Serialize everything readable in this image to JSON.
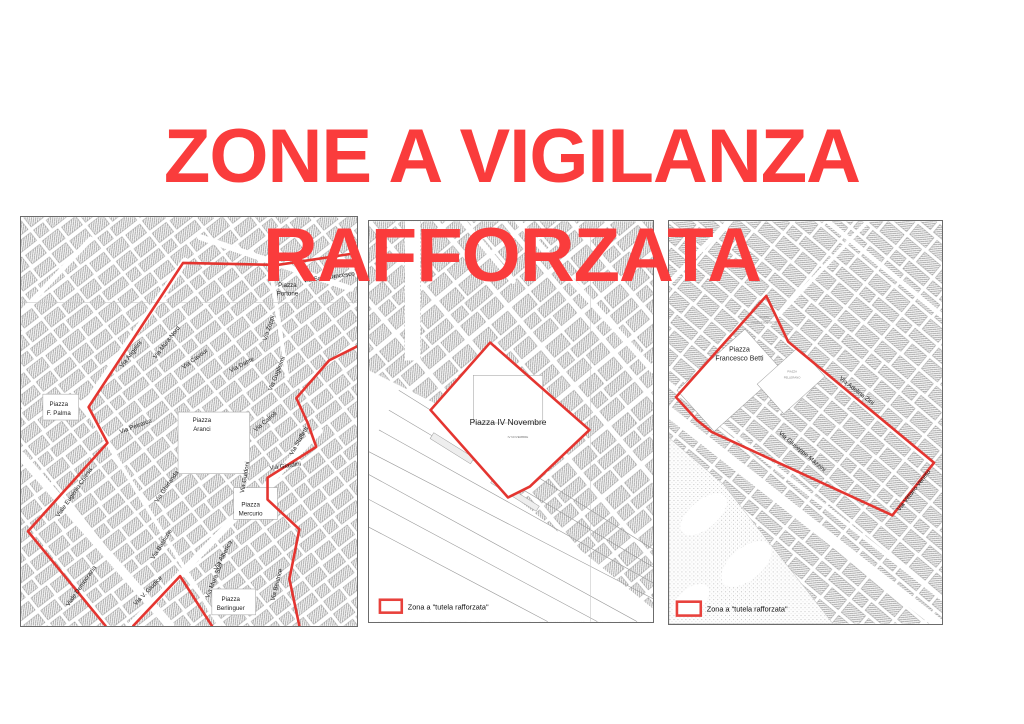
{
  "title": {
    "line1": "ZONE A VIGILANZA",
    "line2": "RAFFORZATA",
    "color": "#fa3c3c"
  },
  "legend": {
    "label": "Zona a \"tutela rafforzata\""
  },
  "colors": {
    "zone_red": "#e43530",
    "title_red": "#fa3c3c",
    "map_border": "#6b6b6b"
  },
  "maps": {
    "left": {
      "labels": [
        {
          "text": "Via Angelini",
          "x": 112,
          "y": 139,
          "rot": -52
        },
        {
          "text": "Via Mura Nord",
          "x": 148,
          "y": 127,
          "rot": -52
        },
        {
          "text": "Via Zoppi",
          "x": 251,
          "y": 112,
          "rot": -72
        },
        {
          "text": "Via Cavour",
          "x": 176,
          "y": 144,
          "rot": -36
        },
        {
          "text": "Via Dante",
          "x": 223,
          "y": 150,
          "rot": -28
        },
        {
          "text": "Via Guglielmi",
          "x": 259,
          "y": 158,
          "rot": -68
        },
        {
          "text": "Via Cairoli",
          "x": 247,
          "y": 207,
          "rot": -40
        },
        {
          "text": "Via Staffetti",
          "x": 281,
          "y": 226,
          "rot": -60
        },
        {
          "text": "Via Giardini",
          "x": 266,
          "y": 252,
          "rot": -8
        },
        {
          "text": "Via Guidoni",
          "x": 227,
          "y": 262,
          "rot": -80
        },
        {
          "text": "Piazza",
          "x": 231,
          "y": 291
        },
        {
          "text": "Mercurio",
          "x": 231,
          "y": 300
        },
        {
          "text": "Via Alberica",
          "x": 205,
          "y": 341,
          "rot": -62
        },
        {
          "text": "Via Mura Sud",
          "x": 196,
          "y": 366,
          "rot": -68
        },
        {
          "text": "Piazza",
          "x": 211,
          "y": 386
        },
        {
          "text": "Berlinguer",
          "x": 211,
          "y": 395
        },
        {
          "text": "Via Beatrice",
          "x": 259,
          "y": 370,
          "rot": -76
        },
        {
          "text": "Via Bastione",
          "x": 143,
          "y": 330,
          "rot": -58
        },
        {
          "text": "Via Ghirlanda",
          "x": 148,
          "y": 272,
          "rot": -55
        },
        {
          "text": "Via V. Giudice",
          "x": 129,
          "y": 377,
          "rot": -46
        },
        {
          "text": "Viale Eugenio Chiesa",
          "x": 55,
          "y": 278,
          "rot": -55
        },
        {
          "text": "Viale Democrazia",
          "x": 62,
          "y": 372,
          "rot": -55
        },
        {
          "text": "Via Petrarca",
          "x": 116,
          "y": 212,
          "rot": -20
        },
        {
          "text": "Piazza",
          "x": 38,
          "y": 190
        },
        {
          "text": "F. Palma",
          "x": 38,
          "y": 199
        },
        {
          "text": "Piazza",
          "x": 182,
          "y": 206
        },
        {
          "text": "Aranci",
          "x": 182,
          "y": 215
        },
        {
          "text": "Piazza",
          "x": 268,
          "y": 70
        },
        {
          "text": "Portone",
          "x": 268,
          "y": 79
        },
        {
          "text": "Via San Francesco",
          "x": 310,
          "y": 62,
          "rot": -8
        }
      ]
    },
    "center": {
      "labels": [
        {
          "text": "Piazza IV Novembre",
          "x": 140,
          "y": 205,
          "size": 8.5
        },
        {
          "text": "IV NOVEMBRE",
          "x": 150,
          "y": 218,
          "size": 3,
          "color": "#777777"
        }
      ]
    },
    "right": {
      "labels": [
        {
          "text": "Piazza",
          "x": 71,
          "y": 131,
          "size": 7
        },
        {
          "text": "Francesco Betti",
          "x": 71,
          "y": 140,
          "size": 7
        },
        {
          "text": "PIAZZA",
          "x": 96,
          "y": 97,
          "size": 2.8,
          "color": "#888888"
        },
        {
          "text": "FRANCESCO BETTI",
          "x": 96,
          "y": 103,
          "size": 2.8,
          "color": "#888888"
        },
        {
          "text": "PIAZZA",
          "x": 124,
          "y": 152,
          "size": 2.8,
          "color": "#888888"
        },
        {
          "text": "PELLERANO",
          "x": 124,
          "y": 158,
          "size": 2.8,
          "color": "#888888"
        },
        {
          "text": "Via Adelina Zini",
          "x": 188,
          "y": 172,
          "rot": 38
        },
        {
          "text": "Via Giuseppe Mazzini",
          "x": 133,
          "y": 233,
          "rot": 40
        },
        {
          "text": "Via Vittorio Veneto",
          "x": 248,
          "y": 272,
          "rot": -52
        }
      ]
    }
  }
}
